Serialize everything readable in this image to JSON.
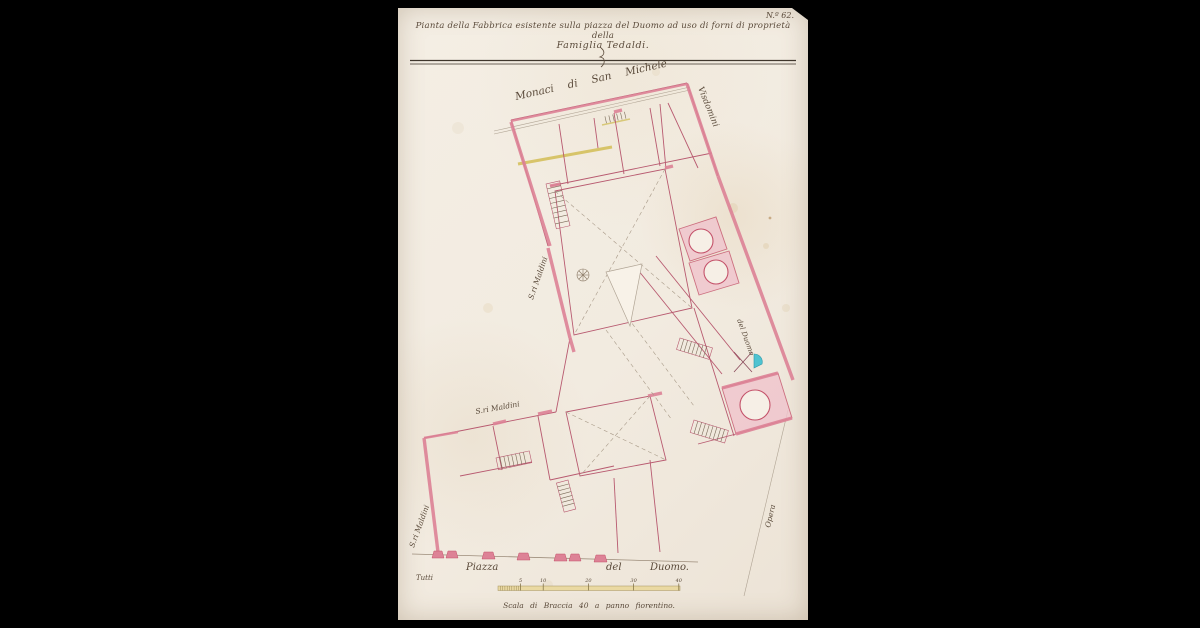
{
  "document": {
    "archive_number": "N.º 62.",
    "title": {
      "line1": "Pianta della Fabbrica esistente sulla piazza del Duomo ad uso di forni di proprietà della",
      "line2": "Famiglia Tedaldi."
    },
    "plan_labels": {
      "monastery": "Monaci di San Michele",
      "street_visdomini": "Visdomini",
      "maldini_upper": "S.ri Maldini",
      "maldini_middle": "S.ri Maldini",
      "maldini_lower": "S.ri Maldini",
      "street_del_duomo": "del Duomo",
      "opera": "Opera",
      "piazza": [
        "Piazza",
        "del",
        "Duomo."
      ],
      "pencil_note": "Tutti"
    },
    "scale_bar": {
      "caption": "Scala di Braccia 40 a panno fiorentino.",
      "tick_labels": [
        "5",
        "10",
        "20",
        "30",
        "40"
      ]
    },
    "colors": {
      "paper": "#f2ebe1",
      "wall_pink": "#dd8296",
      "wall_outline": "#c4526a",
      "room_wash": "#f0c4cd",
      "ink": "#5a4a3a",
      "yellow": "#d2bd55",
      "cyan": "#4fc3d1"
    }
  }
}
